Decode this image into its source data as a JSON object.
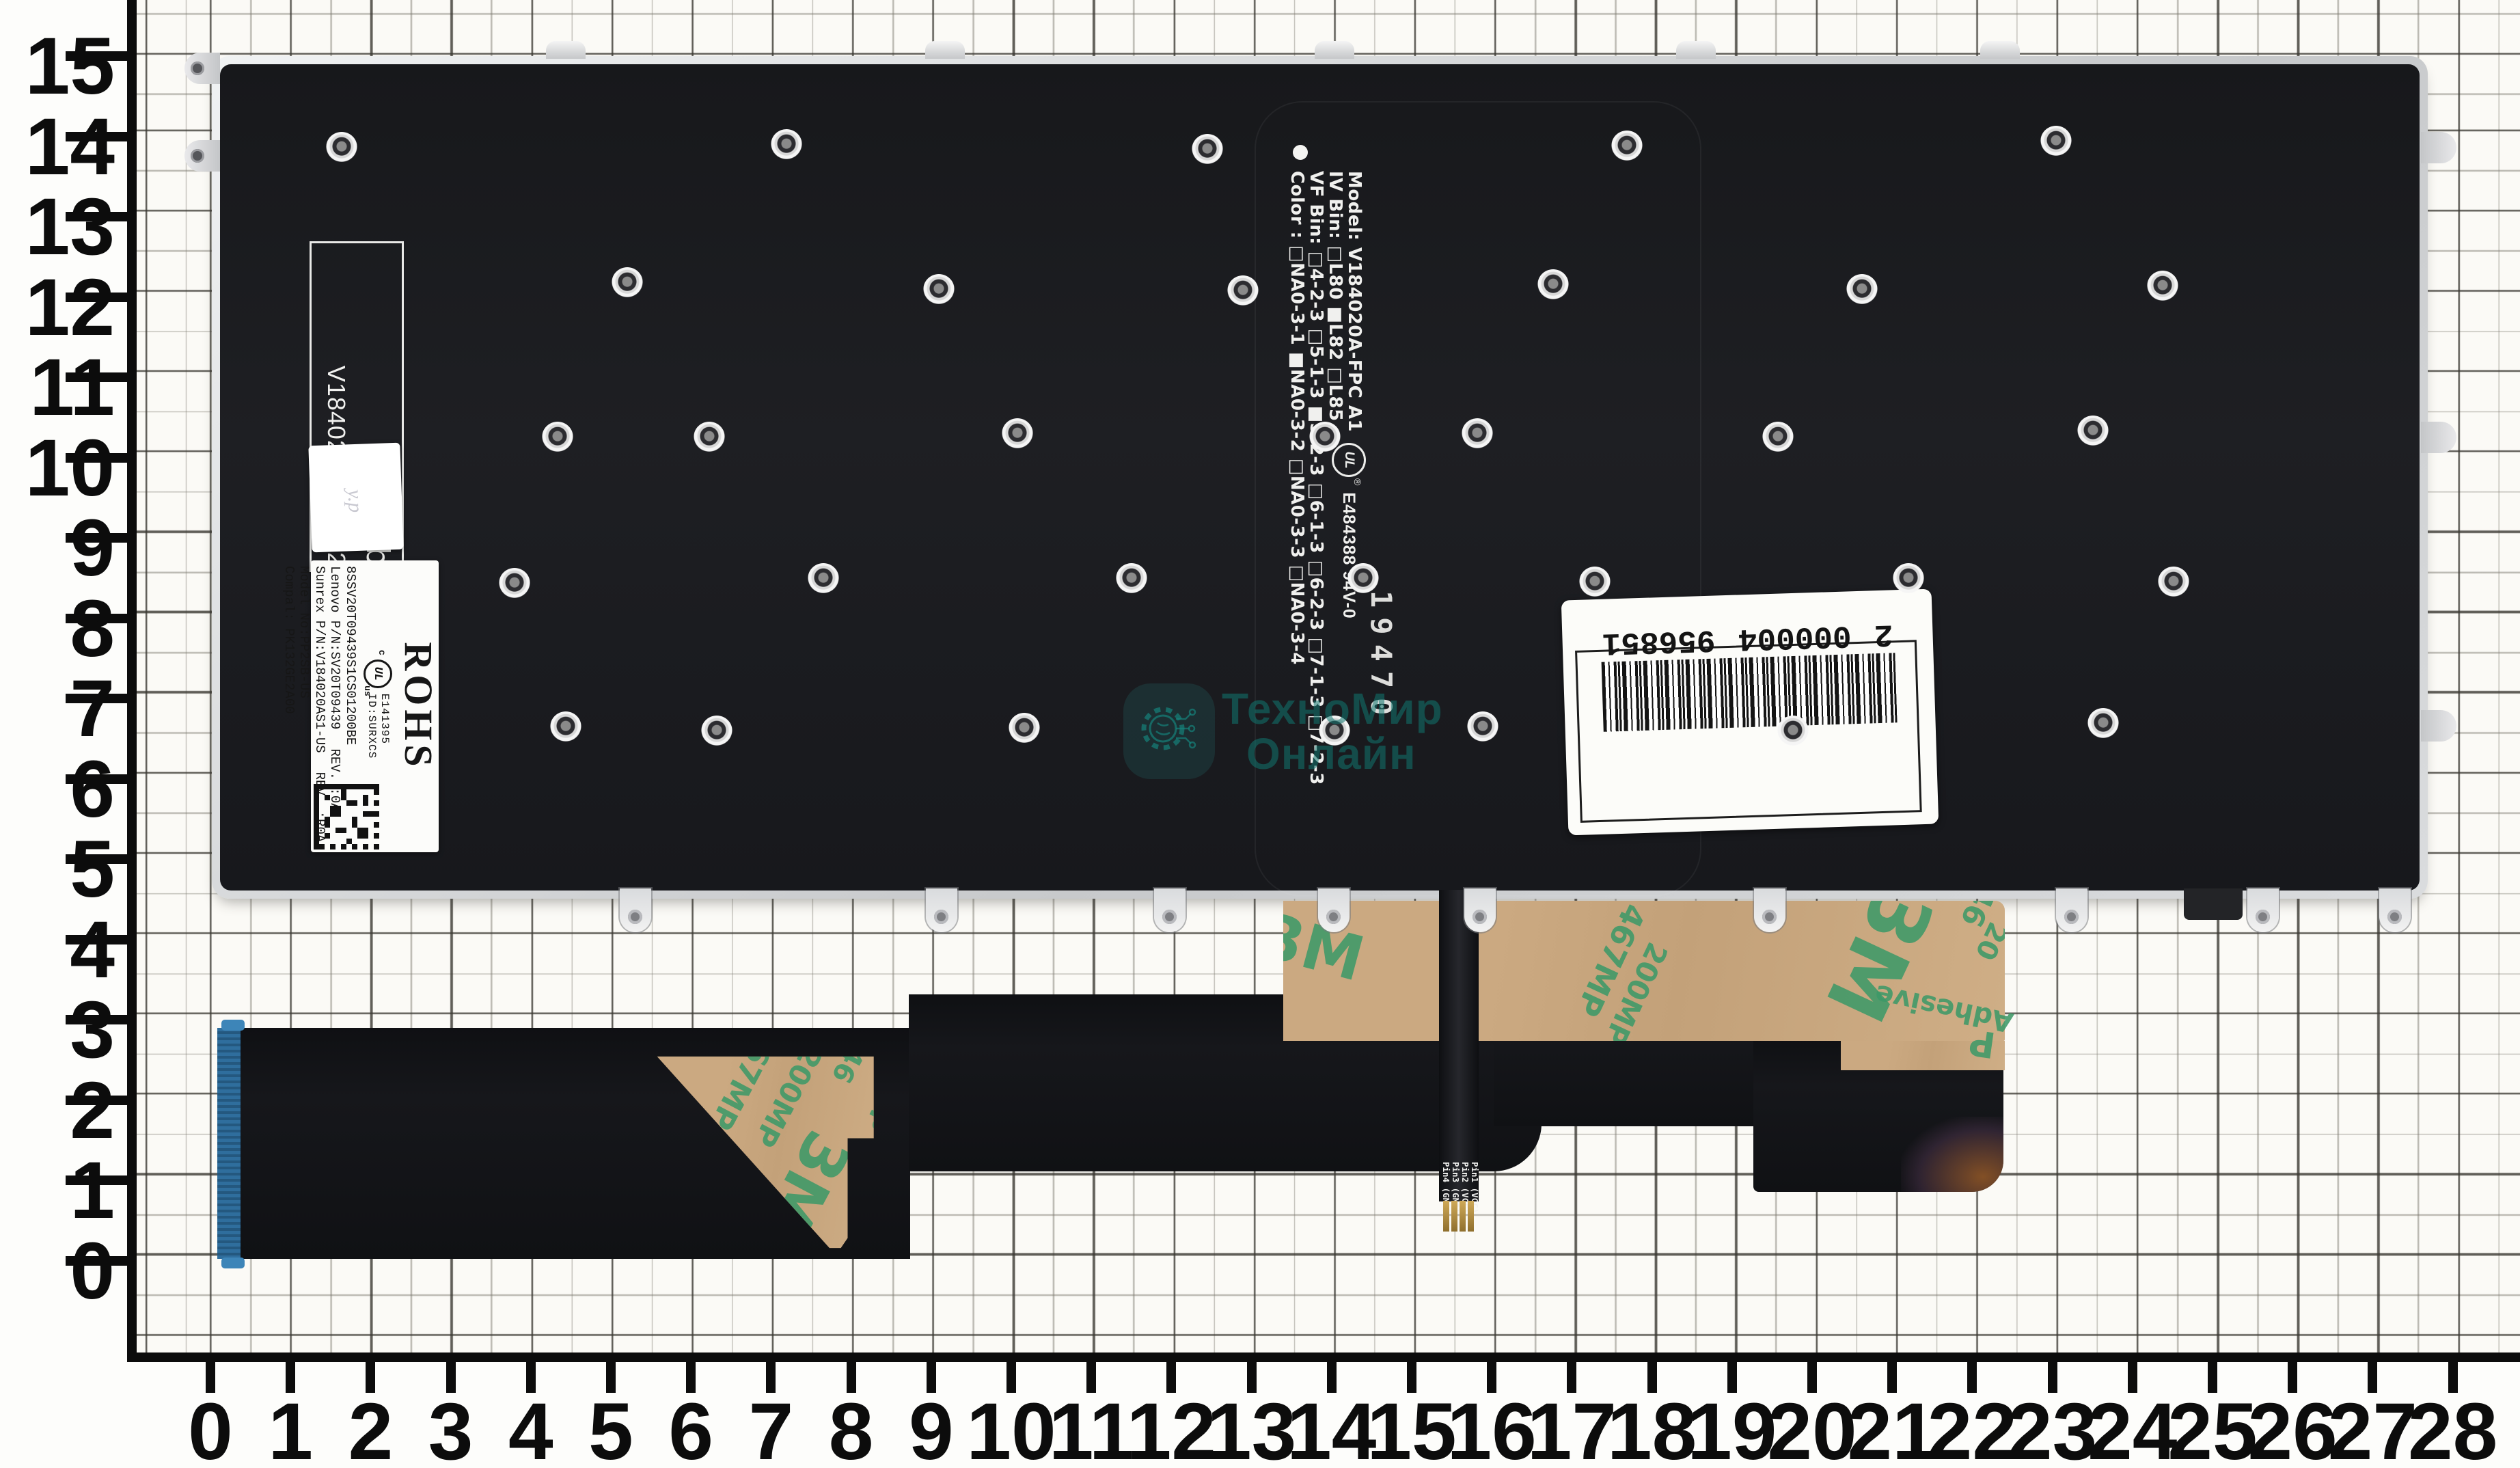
{
  "photo": {
    "watermark": {
      "line1": "ТехноМир",
      "line2": "Онлайн"
    },
    "rulers": {
      "left_labels": [
        "15",
        "14",
        "13",
        "12",
        "11",
        "10",
        "9",
        "8",
        "7",
        "6",
        "5",
        "4",
        "3",
        "2",
        "1",
        "0"
      ],
      "bottom_labels": [
        "0",
        "1",
        "2",
        "3",
        "4",
        "5",
        "6",
        "7",
        "8",
        "9",
        "10",
        "11",
        "12",
        "13",
        "14",
        "15",
        "16",
        "17",
        "18",
        "19",
        "20",
        "21",
        "22",
        "23",
        "24",
        "25",
        "26",
        "27",
        "28"
      ]
    },
    "plate": {
      "print_block": {
        "line1": "Model: V184020A-FPC A1",
        "line2": "IV Bin: □L80 ■L82 □L85",
        "line3": "VF Bin: □4-2-3 □5-1-3 ■5-2-3 □6-1-3 □6-2-3 □7-1-3 □7-2-3",
        "line4": "Color : □NA0-3-1 ■NA0-3-2 □NA0-3-3 □NA0-3-4"
      },
      "ul_mark": {
        "ul": "UL",
        "reg": "®",
        "number": "E484388 94V-0"
      },
      "date_stamp": "19470",
      "bl_box": {
        "line1": "BL Lab",
        "line2": "V184020A-RF A2"
      },
      "hand_note": "у.р",
      "rohs_label": {
        "rohs": "ROHS",
        "cert_c": "c",
        "cert_ul": "UL",
        "cert_us": "us",
        "cert_no": "E141395",
        "cert_id": "ID:SURXCS",
        "serial": "8SSV20T09439S1CS01200BE",
        "lenovo": "Lenovo P/N:SV20T09439",
        "lenovo_rev": "REV. :0A",
        "sunrex": "Sunrex P/N:V184020AS1-US",
        "sunrex_rev": "REV. :R0A",
        "model": "Model No:PP2SB-US",
        "compal": "Compal: PK132GE2A00"
      },
      "barcode": {
        "digits_left": "2",
        "digits_mid": "000004",
        "digits_right": "956851"
      }
    },
    "tape": {
      "brand": "3M",
      "p467": "467MP",
      "p200": "200MP",
      "adhesive": "Adhesive",
      "p46": "46",
      "p20": "20",
      "p_letter": "P"
    },
    "cable": {
      "pins": [
        "Pin4 (GND)",
        "Pin3 (GND)",
        "Pin2 (VCC)",
        "Pin1 (VCC)"
      ]
    }
  }
}
